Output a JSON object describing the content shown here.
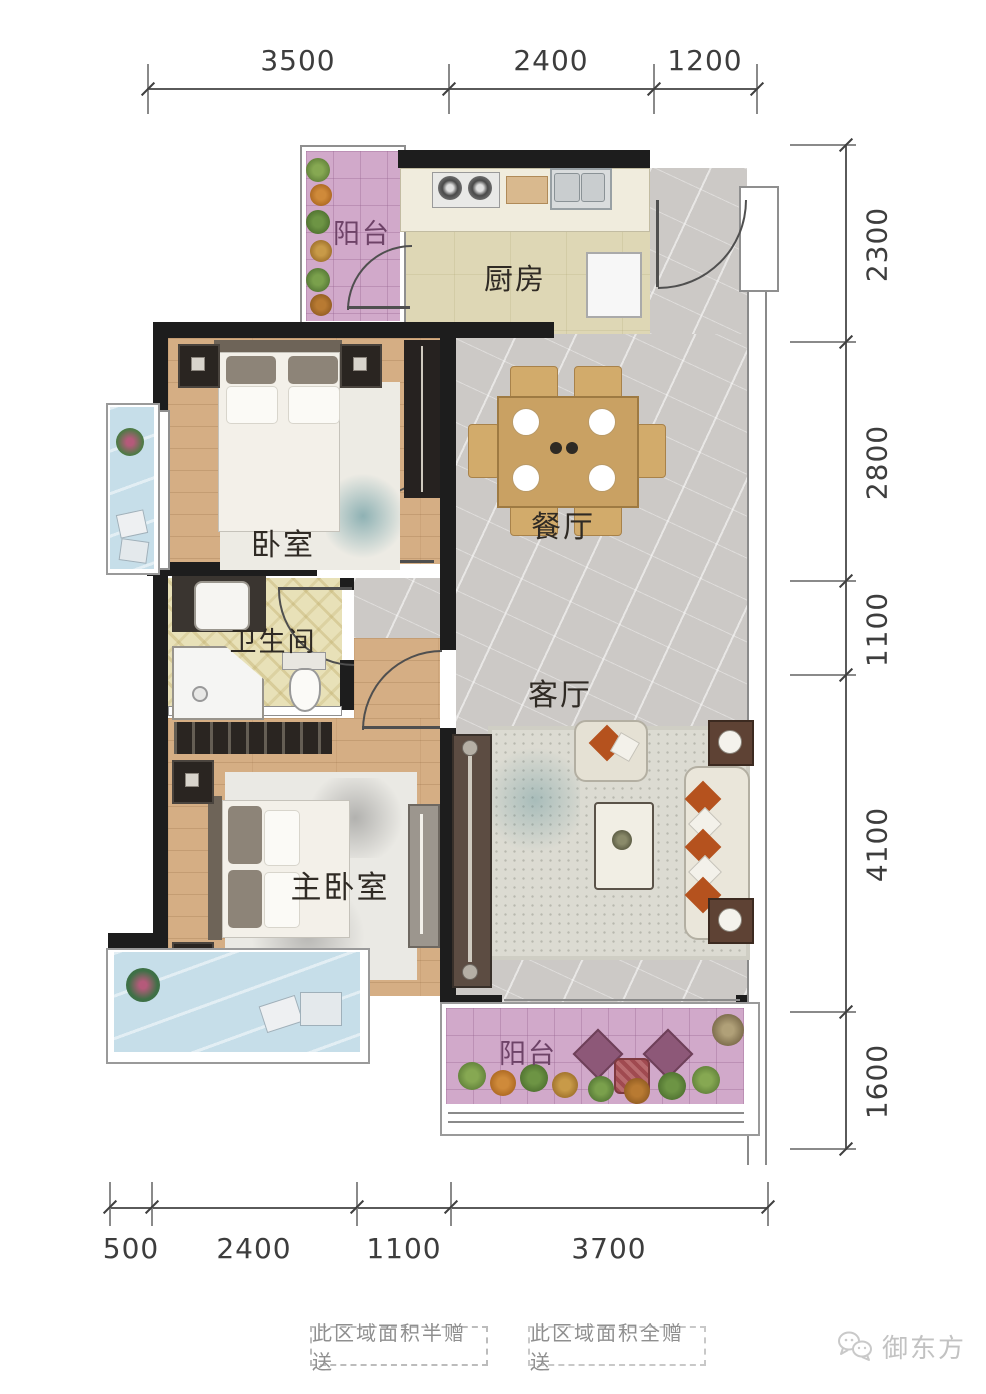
{
  "plan": {
    "rooms": {
      "balcony_top": {
        "label": "阳台"
      },
      "kitchen": {
        "label": "厨房"
      },
      "bedroom": {
        "label": "卧室"
      },
      "dining": {
        "label": "餐厅"
      },
      "bathroom": {
        "label": "卫生间"
      },
      "living": {
        "label": "客厅"
      },
      "master_bedroom": {
        "label": "主卧室"
      },
      "balcony_bottom": {
        "label": "阳台"
      }
    },
    "dimensions": {
      "top": [
        "3500",
        "2400",
        "1200"
      ],
      "right": [
        "2300",
        "2800",
        "1100",
        "4100",
        "1600"
      ],
      "bottom": [
        "500",
        "2400",
        "1100",
        "3700"
      ]
    }
  },
  "legend": {
    "half": "此区域面积半赠送",
    "full": "此区域面积全赠送"
  },
  "watermark": {
    "icon": "wechat-bubbles-icon",
    "brand": "御东方"
  },
  "colors": {
    "wall": "#1d1d1d",
    "wood_floor": "#d5ae84",
    "marble_floor": "#ccc9c6",
    "kitchen_floor": "#ded7b5",
    "bath_floor": "#e8e1b8",
    "balcony_pink": "#d1a9ca",
    "platform_blue": "#c6dee9",
    "pillow_orange": "#b5521e",
    "dim_text": "#3d3d3d"
  }
}
